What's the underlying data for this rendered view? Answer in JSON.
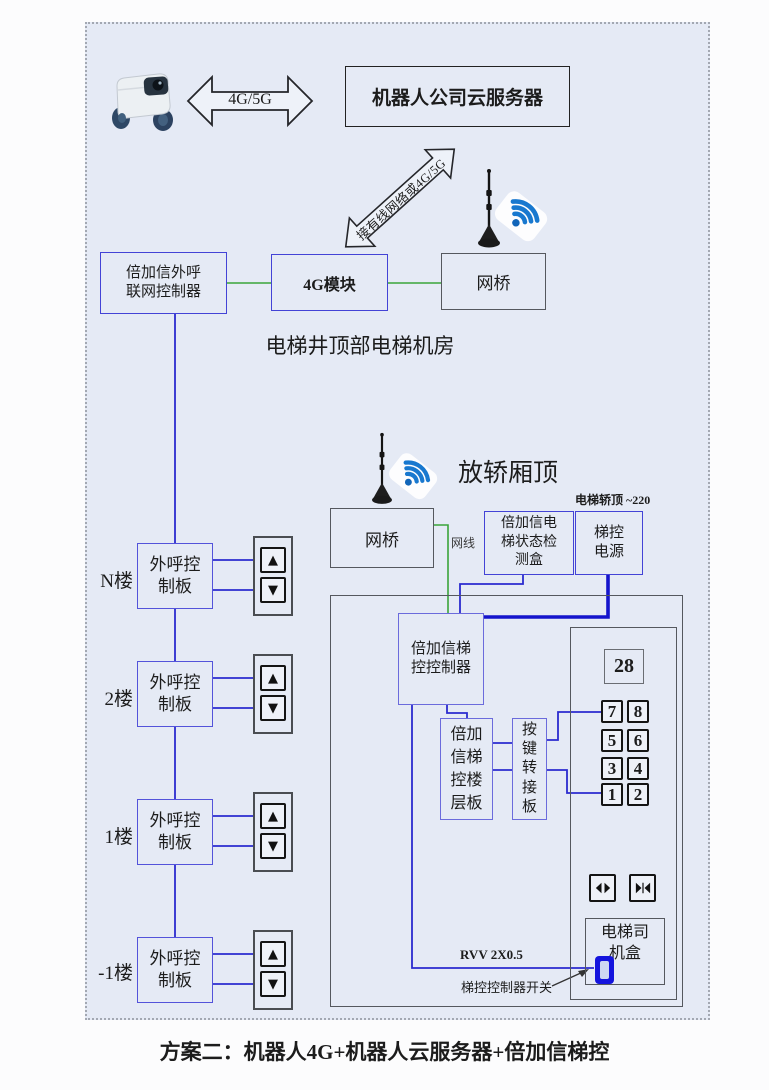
{
  "title_caption": "方案二：机器人4G+机器人云服务器+倍加信梯控",
  "top_section": {
    "robot_icon": "delivery-robot-icon",
    "robot_cloud_link": "4G/5G",
    "cloud_server_box": "机器人公司云服务器",
    "uplink_arrow_label": "接有线网络或4G/5G"
  },
  "machine_room": {
    "caption": "电梯井顶部电梯机房",
    "outcall_controller_box": "倍加信外呼\n联网控制器",
    "module_4g_box": "4G模块",
    "bridge_box": "网桥",
    "antenna_icon": "antenna-wifi"
  },
  "car_top": {
    "caption": "放轿厢顶",
    "antenna_icon": "antenna-wifi",
    "power_note": "电梯轿顶 ~220",
    "bridge_box": "网桥",
    "cable_label": "网线",
    "status_box": "倍加信电\n梯状态检\n测盒",
    "power_box": "梯控\n电源"
  },
  "cabin": {
    "controller_box": "倍加信梯\n控控制器",
    "floor_board_box": "倍加\n信梯\n控楼\n层板",
    "key_adapter_box": "按\n键\n转\n接\n板",
    "floor_display": "28",
    "keypad": [
      "7",
      "8",
      "5",
      "6",
      "3",
      "4",
      "1",
      "2"
    ],
    "driver_box": "电梯司\n机盒",
    "wire_label": "RVV 2X0.5",
    "switch_label": "梯控控制器开关"
  },
  "floors": [
    {
      "label": "N楼",
      "board": "外呼控\n制板"
    },
    {
      "label": "2楼",
      "board": "外呼控\n制板"
    },
    {
      "label": "1楼",
      "board": "外呼控\n制板"
    },
    {
      "label": "-1楼",
      "board": "外呼控\n制板"
    }
  ],
  "icons": {
    "up": "▲",
    "down": "▼"
  },
  "colors": {
    "wire_blue": "#2b2bcf",
    "wire_green": "#3aa43a",
    "box_blue": "#4343d6",
    "wifi_blue": "#1878cf"
  }
}
